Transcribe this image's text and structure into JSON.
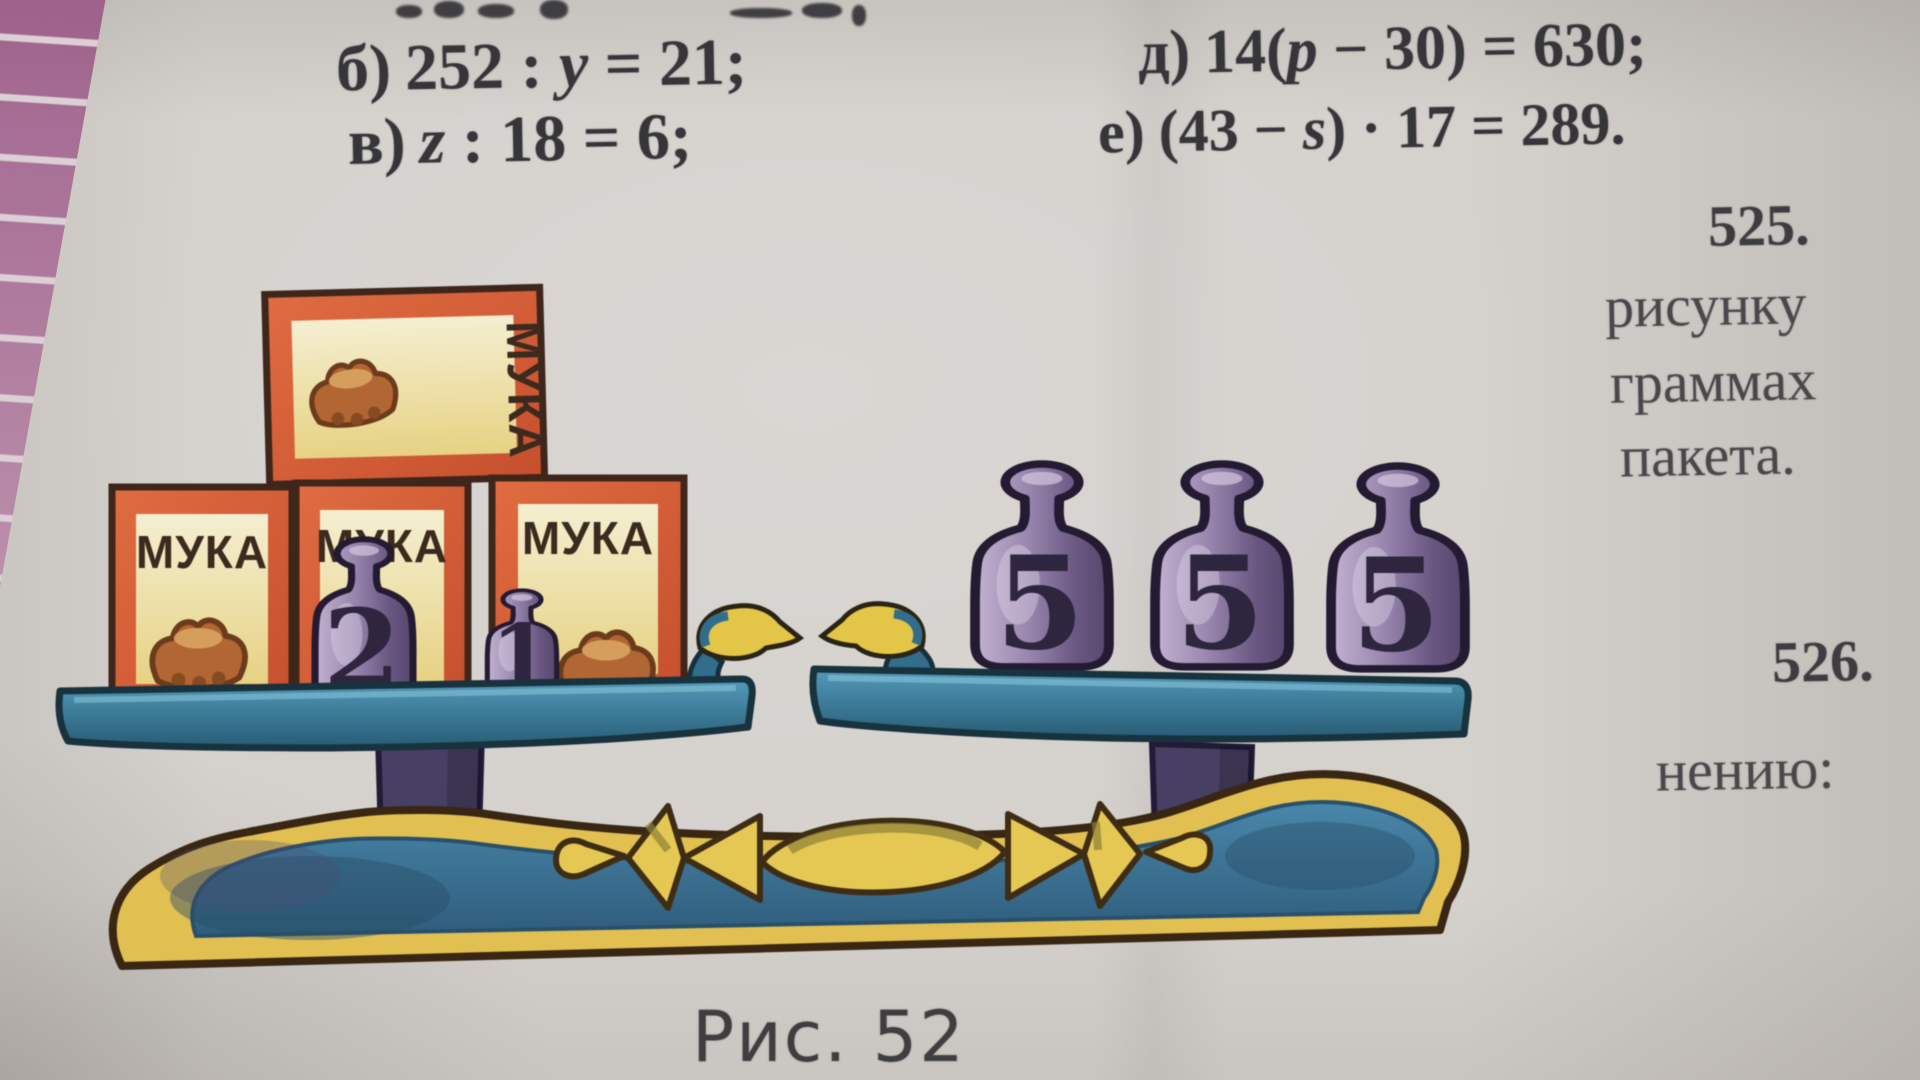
{
  "equations": {
    "b": {
      "label": "б)",
      "pre": "252 : ",
      "variable": "y",
      "post": " = 21;"
    },
    "v": {
      "label": "в)",
      "pre": "",
      "variable": "z",
      "post": " : 18 = 6;"
    },
    "d": {
      "label": "д)",
      "pre": "14(",
      "variable": "p",
      "post": " − 30) = 630;"
    },
    "e": {
      "label": "е)",
      "pre": "(43 − ",
      "variable": "s",
      "post": ") · 17 = 289."
    }
  },
  "margin_column": {
    "problem_525": "525.",
    "word_1": "рисунку",
    "word_2": "граммах",
    "word_3": "пакета.",
    "problem_526": "526.",
    "word_4": "нению:"
  },
  "figure": {
    "caption": "Рис. 52",
    "flour_label": "МУКА",
    "left_weights": [
      "2",
      "1"
    ],
    "right_weights": [
      "5",
      "5",
      "5"
    ],
    "colors": {
      "box_orange": "#dc5f35",
      "label_cream": "#f2ebc6",
      "weight_purple": "#8e7aa4",
      "pan_blue": "#2f6e8e",
      "pedestal_slate": "#474066",
      "base_yellow": "#e3bf4a",
      "base_blue": "#3c7ba0",
      "beak_yellow": "#e5c53f",
      "ink_brown": "#3c2a1c",
      "tile_pink": "#b07d9f",
      "page_gray": "#d5d2ce"
    }
  }
}
